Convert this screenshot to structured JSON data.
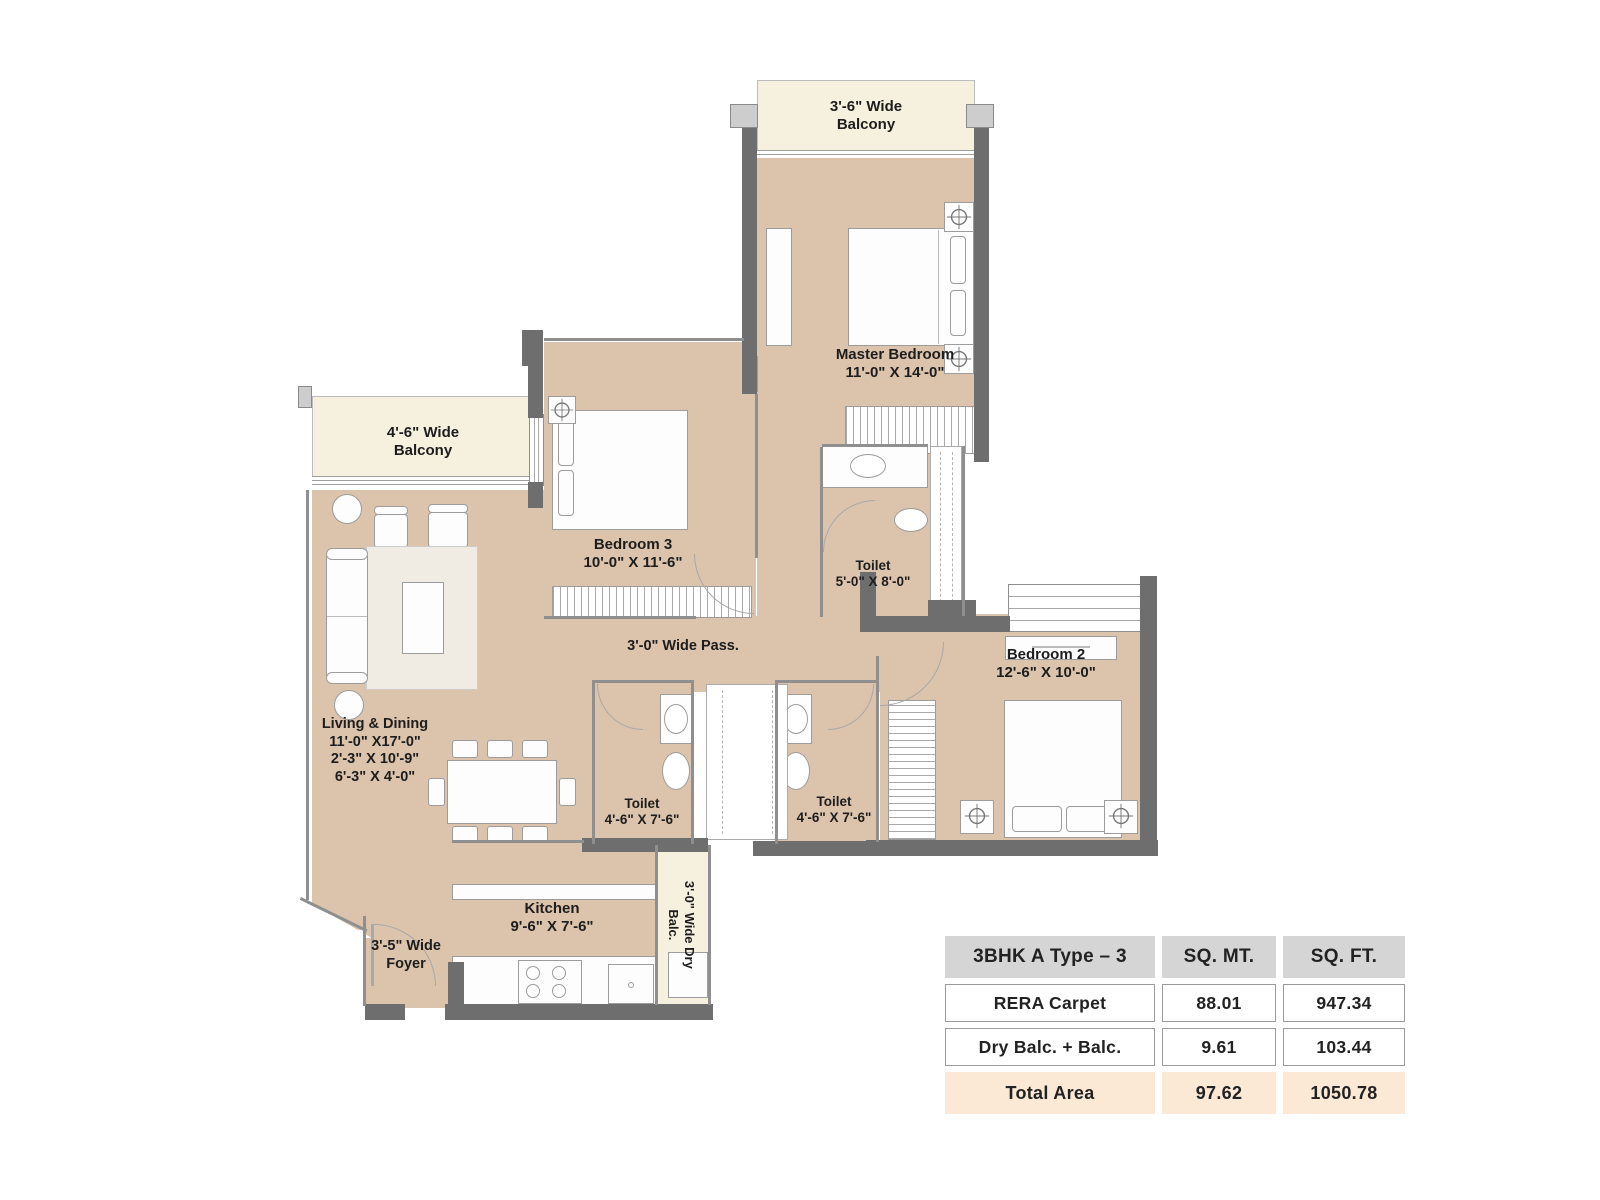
{
  "colors": {
    "floor": "#dcc3ab",
    "balcony": "#f6f0de",
    "wall_dark": "#6e6e6e",
    "table_header_bg": "#d5d5d5",
    "table_total_bg": "#fbe9d5"
  },
  "labels": {
    "balcony_top_l1": "3'-6\" Wide",
    "balcony_top_l2": "Balcony",
    "balcony_left_l1": "4'-6\" Wide",
    "balcony_left_l2": "Balcony",
    "dry_balc_l1": "3'-0\" Wide Dry",
    "dry_balc_l2": "Balc.",
    "foyer_l1": "3'-5\" Wide",
    "foyer_l2": "Foyer",
    "passage": "3'-0\" Wide Pass.",
    "master_name": "Master Bedroom",
    "master_dims": "11'-0\" X 14'-0\"",
    "bed3_name": "Bedroom 3",
    "bed3_dims": "10'-0\" X 11'-6\"",
    "bed2_name": "Bedroom 2",
    "bed2_dims": "12'-6\" X 10'-0\"",
    "toilet_master_name": "Toilet",
    "toilet_master_dims": "5'-0\" X 8'-0\"",
    "toilet_a_name": "Toilet",
    "toilet_a_dims": "4'-6\" X 7'-6\"",
    "toilet_b_name": "Toilet",
    "toilet_b_dims": "4'-6\" X 7'-6\"",
    "kitchen_name": "Kitchen",
    "kitchen_dims": "9'-6\" X 7'-6\"",
    "living_name": "Living & Dining",
    "living_dim1": "11'-0\" X17'-0\"",
    "living_dim2": "2'-3\" X 10'-9\"",
    "living_dim3": "6'-3\" X 4'-0\""
  },
  "area_table": {
    "title": "3BHK A Type – 3",
    "col_sqmt": "SQ. MT.",
    "col_sqft": "SQ. FT.",
    "rows": [
      {
        "label": "RERA Carpet",
        "sqmt": "88.01",
        "sqft": "947.34"
      },
      {
        "label": "Dry Balc. + Balc.",
        "sqmt": "9.61",
        "sqft": "103.44"
      }
    ],
    "total": {
      "label": "Total Area",
      "sqmt": "97.62",
      "sqft": "1050.78"
    }
  }
}
